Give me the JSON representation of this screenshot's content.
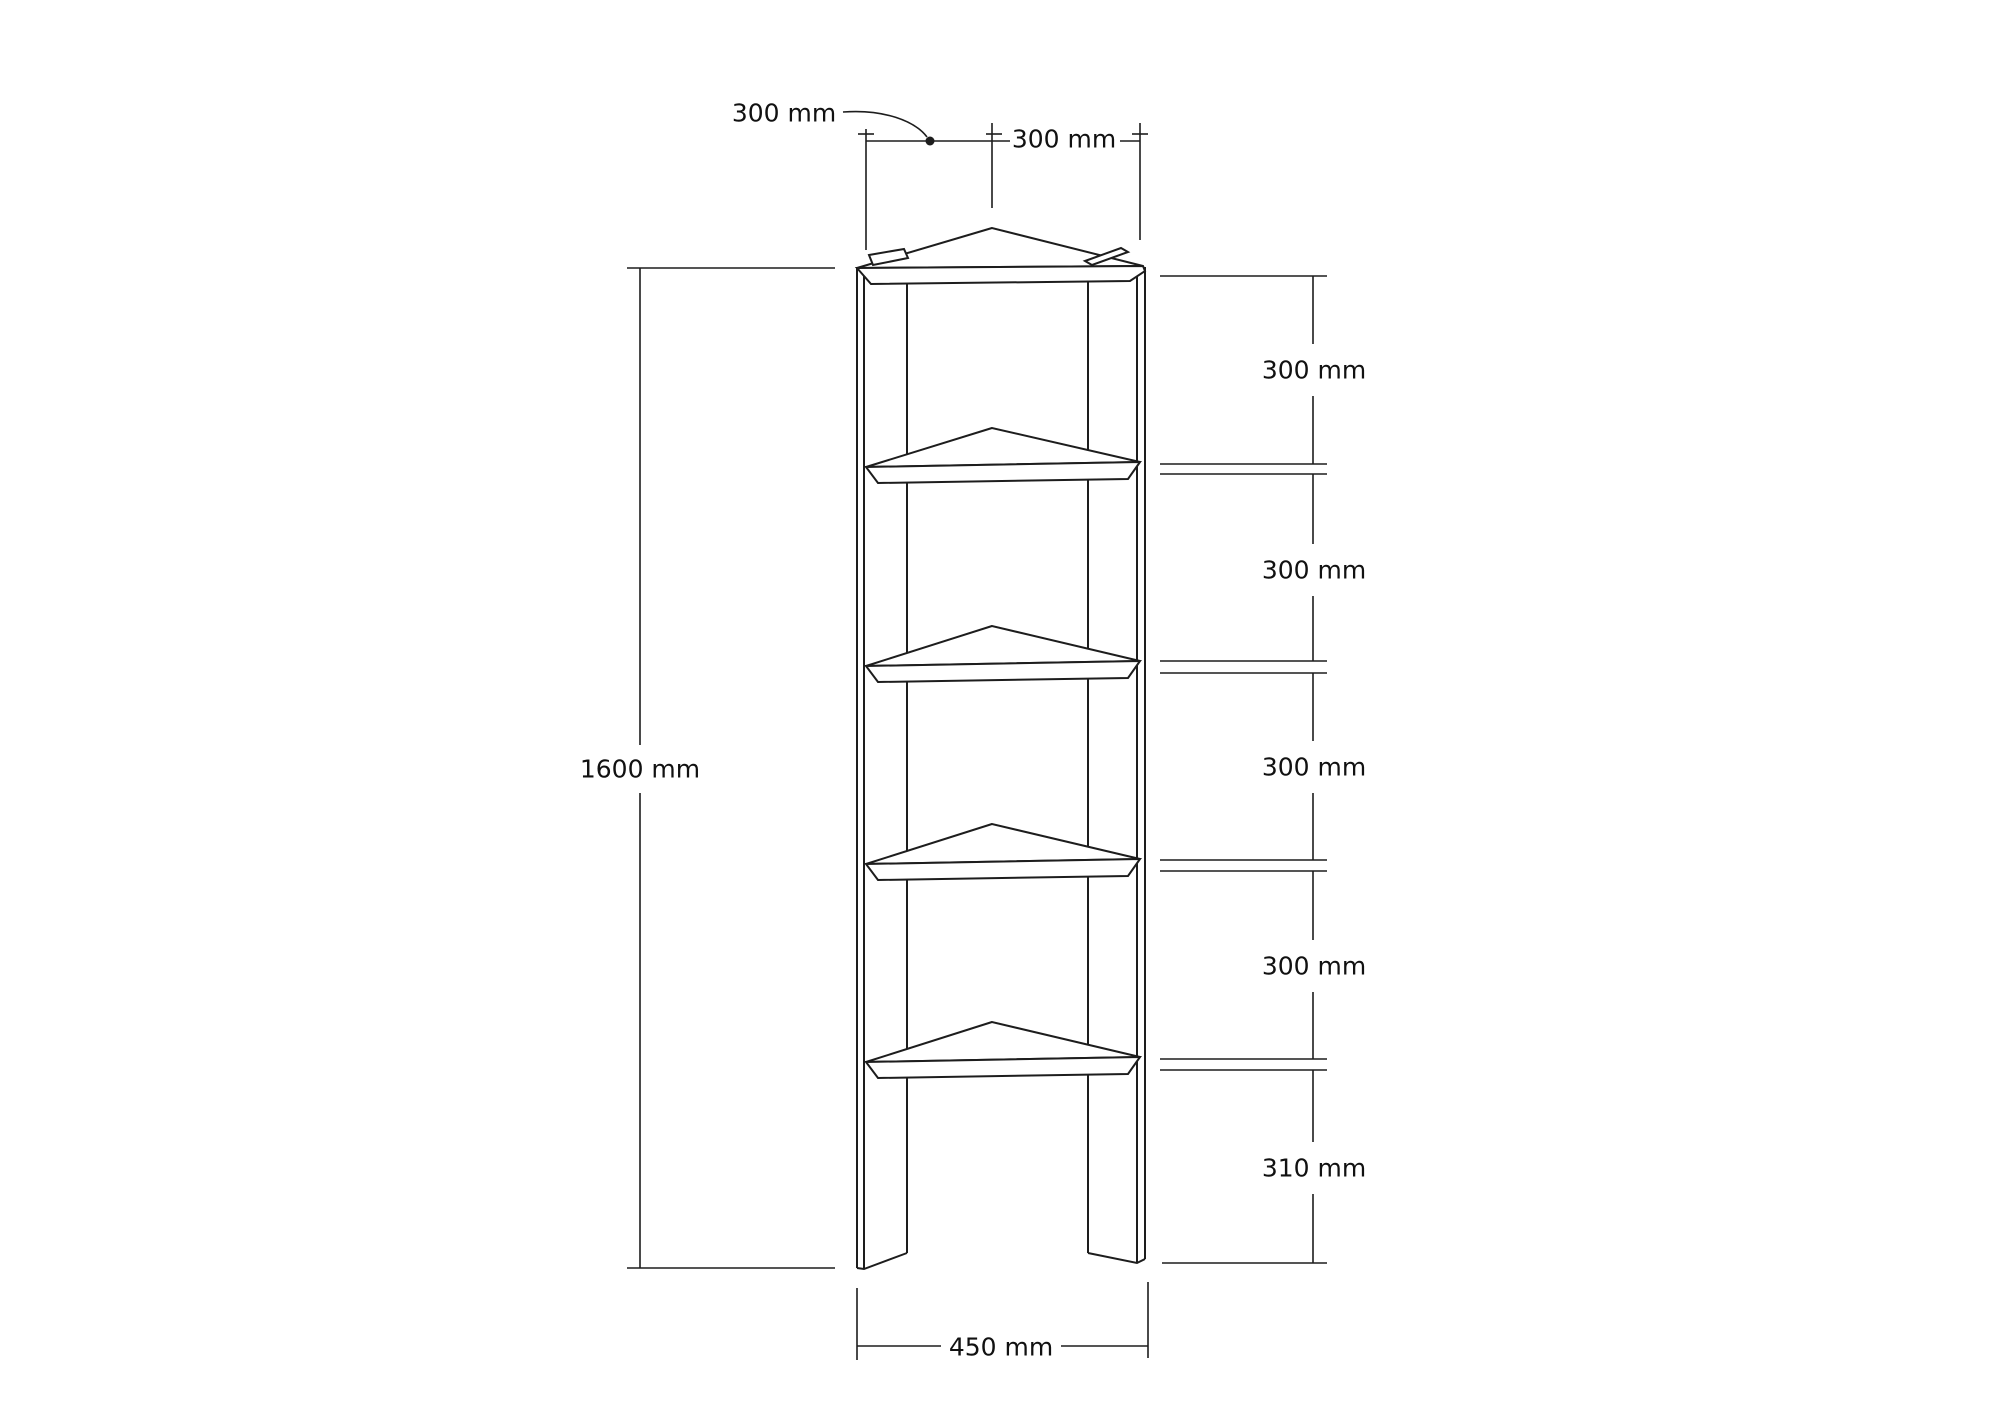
{
  "page": {
    "background": "#ffffff",
    "line_color": "#1d1d1d",
    "text_color": "#111111"
  },
  "drawing": {
    "kind": "furniture-dimension-diagram",
    "object": "corner shelf unit with five triangular shelves and two side panels",
    "dimensions": {
      "top_depth": {
        "label": "300 mm"
      },
      "top_width": {
        "label": "300 mm"
      },
      "total_height": {
        "label": "1600 mm"
      },
      "shelf_gaps": [
        {
          "label": "300 mm"
        },
        {
          "label": "300 mm"
        },
        {
          "label": "300 mm"
        },
        {
          "label": "300 mm"
        },
        {
          "label": "310 mm"
        }
      ],
      "base_width": {
        "label": "450 mm"
      }
    }
  }
}
